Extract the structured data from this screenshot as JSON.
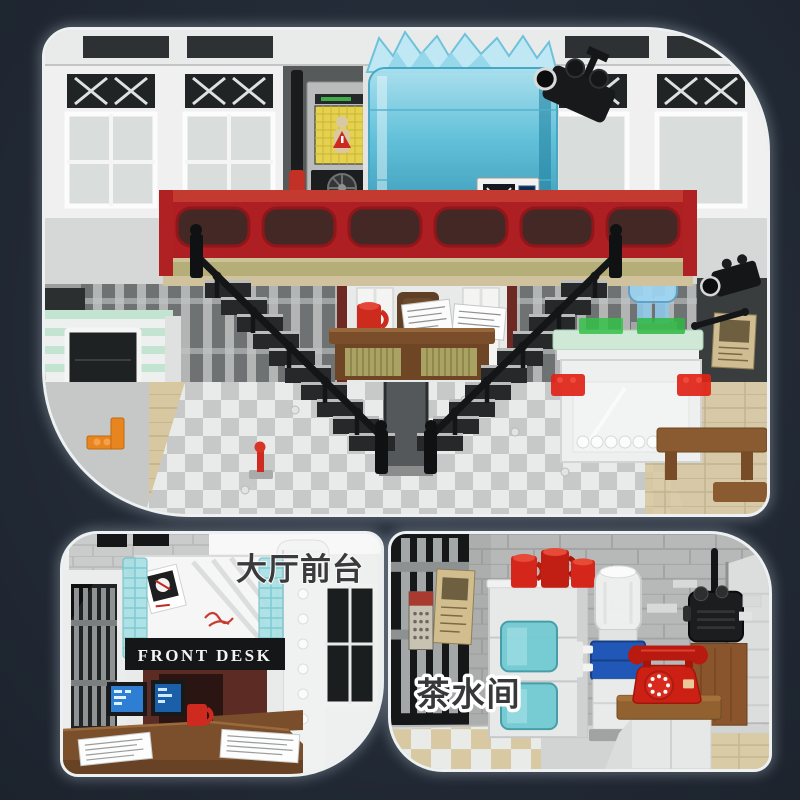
{
  "labels": {
    "lobby": "大厅前台",
    "tearoom": "茶水间",
    "front_desk_sign": "FRONT DESK"
  },
  "colors": {
    "background": "#232b37",
    "panel_border": "#eef1f2",
    "railing_red": "#ad1f22",
    "containment_teal": "#5bc0da",
    "brick_red": "#d5261b",
    "mint_green": "#c3e4d0",
    "cooler_blue": "#2158b8",
    "wood_brown": "#8a552c",
    "tile_tan": "#d9c9a4",
    "kiosk_screen_yellow": "#e5d14b"
  }
}
